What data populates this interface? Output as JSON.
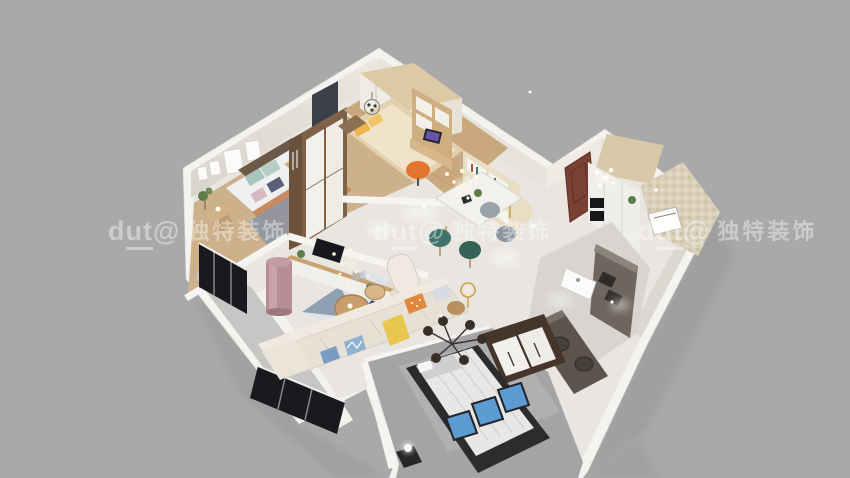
{
  "watermark": {
    "logo_text": "dut@",
    "logo_prefix": "d",
    "logo_underlined": "ut",
    "logo_suffix": "@",
    "brand_text": "独特装饰",
    "repeat_count": 3
  },
  "scene": {
    "type": "3d-dollhouse-floorplan-render",
    "rooms": [
      "master-bedroom",
      "study-bedroom",
      "living-room",
      "dining-area",
      "entry-hall",
      "bathroom",
      "kitchen",
      "second-bedroom",
      "balcony"
    ]
  },
  "palette": {
    "bg": "#a9a9a9",
    "watermark": "rgba(252,252,252,0.42)",
    "wallTop": "#f4f3f0",
    "wallFace": "#e7e3db",
    "wallFaceDark": "#dcd8d1",
    "marbleFloor": "#e9e6e2",
    "woodFloorA": "#cdb18c",
    "woodFloorB": "#c9a87d",
    "grayFloor": "#a4a4a6",
    "kitchenFloor": "#d8d5d0",
    "balconyFloor": "#c7c6c4",
    "mosaic": "#d9cfba",
    "wardrobeBrown": "#7d6148",
    "wardrobeDark": "#45352a",
    "doorBrown": "#7b4034",
    "tealChair": "#3f7268",
    "orangeChair": "#e2762e",
    "yellowAccent": "#e9c64e",
    "bluePanel": "#5d9bd3",
    "sofaFabric": "#e6e0d5",
    "counterDark": "#6e665e",
    "frameBlack": "#191a1d",
    "rugSteel": "#8fa0b2",
    "rugNavy": "#3c4a62",
    "pinkCabinet": "#b68c95"
  }
}
